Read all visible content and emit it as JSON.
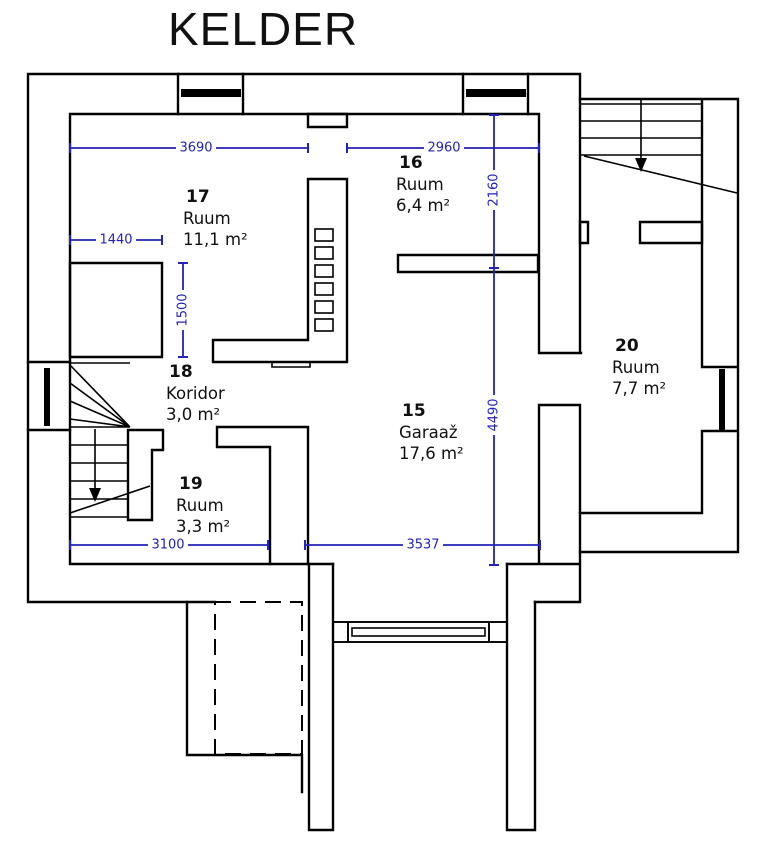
{
  "title": "KELDER",
  "colors": {
    "wall": "#000000",
    "dimension": "#2222b8",
    "background": "#ffffff",
    "text": "#111111"
  },
  "rooms": [
    {
      "number": "15",
      "name": "Garaaž",
      "area": "17,6 m²"
    },
    {
      "number": "16",
      "name": "Ruum",
      "area": "6,4 m²"
    },
    {
      "number": "17",
      "name": "Ruum",
      "area": "11,1 m²"
    },
    {
      "number": "18",
      "name": "Koridor",
      "area": "3,0 m²"
    },
    {
      "number": "19",
      "name": "Ruum",
      "area": "3,3 m²"
    },
    {
      "number": "20",
      "name": "Ruum",
      "area": "7,7 m²"
    }
  ],
  "dimensions": {
    "room17_width": "3690",
    "room16_width": "2960",
    "room16_depth": "2160",
    "closet_width": "1440",
    "closet_depth": "1500",
    "garage_depth": "4490",
    "bottom_left_width": "3100",
    "garage_width": "3537"
  }
}
